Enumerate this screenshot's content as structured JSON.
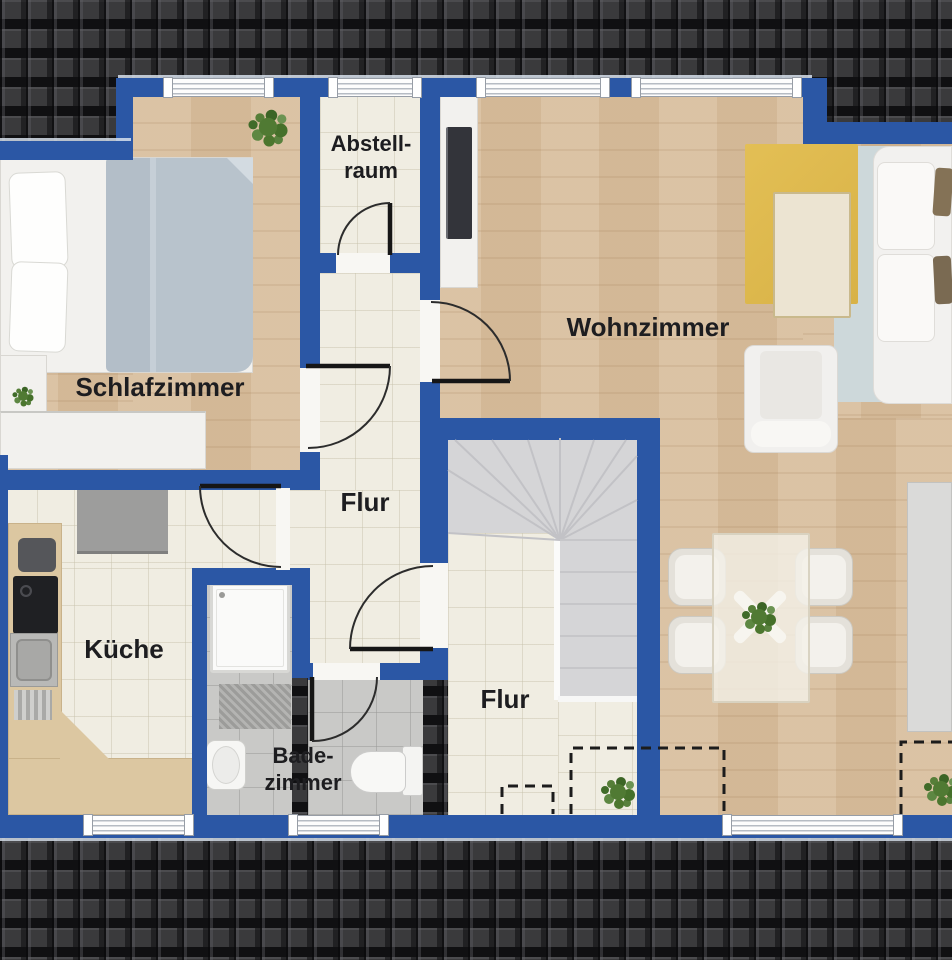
{
  "floorplan": {
    "rooms": [
      {
        "id": "schlafzimmer",
        "label": "Schlafzimmer"
      },
      {
        "id": "abstellraum",
        "label": "Abstell-",
        "label2": "raum"
      },
      {
        "id": "wohnzimmer",
        "label": "Wohnzimmer"
      },
      {
        "id": "flur-upper",
        "label": "Flur"
      },
      {
        "id": "flur-lower",
        "label": "Flur"
      },
      {
        "id": "kueche",
        "label": "Küche"
      },
      {
        "id": "badezimmer",
        "label": "Bade-",
        "label2": "zimmer"
      }
    ],
    "colors": {
      "wall": "#2b57a5",
      "roof_base": "#3a3a3c",
      "wood": "#d9bf9f",
      "tile": "#f0ede2",
      "bath": "#c9c9c7",
      "stair": "#d5d5d7",
      "rug_yellow": "#e3bf55",
      "rug_blue": "#cdd8da",
      "label_text": "#1d1d20"
    }
  }
}
